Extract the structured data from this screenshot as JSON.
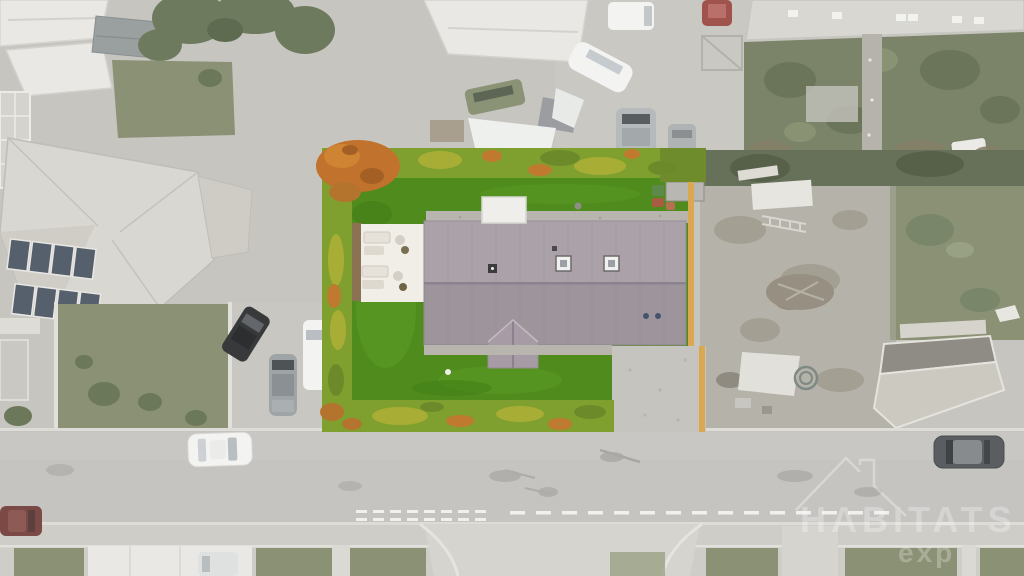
{
  "scene": {
    "description": "Aerial drone photograph of a residential plot: a long mauve-grey gabled roof house inside a vivid green lawn bordered by an autumn-coloured hedge, surrounded by desaturated neighbouring houses, gardens, parked cars and a horizontal road at the bottom.",
    "watermark": {
      "icon": "house-outline-icon",
      "line1": "HABITATS",
      "line2": "exp"
    }
  },
  "colors": {
    "base_concrete": "#c7c5c0",
    "road": "#c5c4c1",
    "road_band": "#cbcac6",
    "sidewalk": "#cfcdc8",
    "curb": "#dedcd7",
    "marking": "#f1f0ec",
    "apron": "#d6d4cf",
    "lawn_muted": "#8b9174",
    "garden_dark": "#7b8468",
    "tree_muted": "#6e7a5e",
    "bush_dark": "#6c785a",
    "hedge_strip_dark": "#67715a",
    "roof_white": "#e9e8e4",
    "roof_light": "#d9d7d2",
    "roof_textured": "#cfccc6",
    "shed_gray": "#9aa0a0",
    "solar": "#55606c",
    "scruffy": "#b5b2a9",
    "debris": "#968f82",
    "lawn": "#4f8c1d",
    "lawn_light": "#5d9c26",
    "lawn_dark": "#3f7a16",
    "hedge": "#7fa02e",
    "hedge_yellow": "#a8ad36",
    "hedge_orange": "#c1722c",
    "hedge_dark": "#6d8a2a",
    "roof_main": "#a79ca5",
    "ridge": "#8b8290",
    "annex": "#efeeea",
    "patio": "#f1eee8",
    "dirt": "#8a7252",
    "gravel": "#b7b5ae",
    "paving": "#c6c4be",
    "fence_yellow": "#d9a850",
    "car_white": "#f3f3f1",
    "car_dark": "#37393b",
    "car_silver": "#9fa4a7",
    "car_gray": "#5b5e60",
    "car_red": "#a0524c",
    "car_maroon": "#7c4a46",
    "car_green": "#8a9375",
    "bin_green": "#5d8a4b",
    "bin_red": "#a85c42",
    "wall": "#e2e0da",
    "watermark": "#ffffff"
  }
}
